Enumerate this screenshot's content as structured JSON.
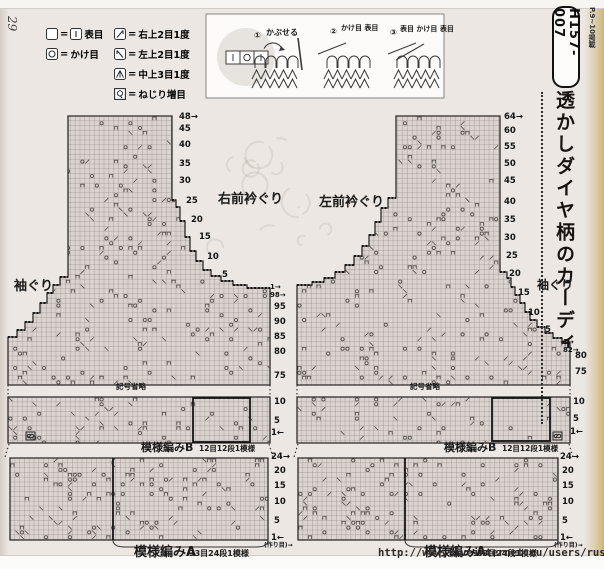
{
  "page": {
    "number": "29",
    "url": "http://www.liveinternet.ru/users/russa_n/"
  },
  "legend": {
    "eq": "=",
    "col1": [
      {
        "icon": "knit-blank-box-icon",
        "icon2": "knit-bar-box-icon",
        "label": "表目"
      },
      {
        "icon": "yarn-over-box-icon",
        "label": "かけ目"
      }
    ],
    "col2": [
      {
        "icon": "right-dec-box-icon",
        "label": "右上2目1度"
      },
      {
        "icon": "left-dec-box-icon",
        "label": "左上2目1度"
      },
      {
        "icon": "center-dec-box-icon",
        "label": "中上3目1度"
      },
      {
        "icon": "twist-inc-box-icon",
        "label": "ねじり増目"
      }
    ]
  },
  "instructions": {
    "steps": [
      {
        "num": "①",
        "label": "かぶせる"
      },
      {
        "num": "②",
        "label": "かけ目 表目"
      },
      {
        "num": "③",
        "label": "表目 かけ目 表目"
      }
    ]
  },
  "sidebar": {
    "issue": "P.9~10掲載",
    "code": "H157-007",
    "title": "透かしダイヤ柄のカーディ"
  },
  "left_chart": {
    "neck_label": "右前衿ぐり",
    "armhole_label": "袖ぐり",
    "neck_numbers": [
      "48→",
      "45",
      "40",
      "35",
      "30",
      "25",
      "20",
      "15",
      "10",
      "5"
    ],
    "row_markers": [
      "1→",
      "98→"
    ],
    "body_numbers": [
      "95",
      "90",
      "85",
      "80",
      "75"
    ],
    "omitted": "記号省略",
    "band_b_numbers": [
      "10",
      "5",
      "1←"
    ],
    "pattern_b": {
      "name": "模様編みB",
      "spec": "12目12段1模様"
    },
    "band_a_numbers": [
      "24→",
      "20",
      "15",
      "10",
      "5",
      "1←"
    ],
    "cast_on": "(作り目)→",
    "pattern_a": {
      "name": "模様編みA",
      "spec": "33目24段1模様"
    }
  },
  "right_chart": {
    "neck_label": "左前衿ぐり",
    "armhole_label": "袖ぐり",
    "edge_numbers": [
      "64→",
      "60",
      "55",
      "50",
      "45",
      "40",
      "35",
      "30",
      "25",
      "20",
      "15",
      "10",
      "5"
    ],
    "row_markers": [
      "1→",
      "82→"
    ],
    "body_numbers": [
      "80",
      "75"
    ],
    "omitted": "記号省略",
    "band_b_numbers": [
      "10",
      "5",
      "1←"
    ],
    "pattern_b": {
      "name": "模様編みB",
      "spec": "12目12段1模様"
    },
    "band_a_numbers": [
      "24→",
      "20",
      "15",
      "10",
      "5",
      "1←"
    ],
    "cast_on": "(作り目)→",
    "pattern_a": {
      "name": "模様編みA",
      "spec": "33目24段1模様"
    }
  }
}
